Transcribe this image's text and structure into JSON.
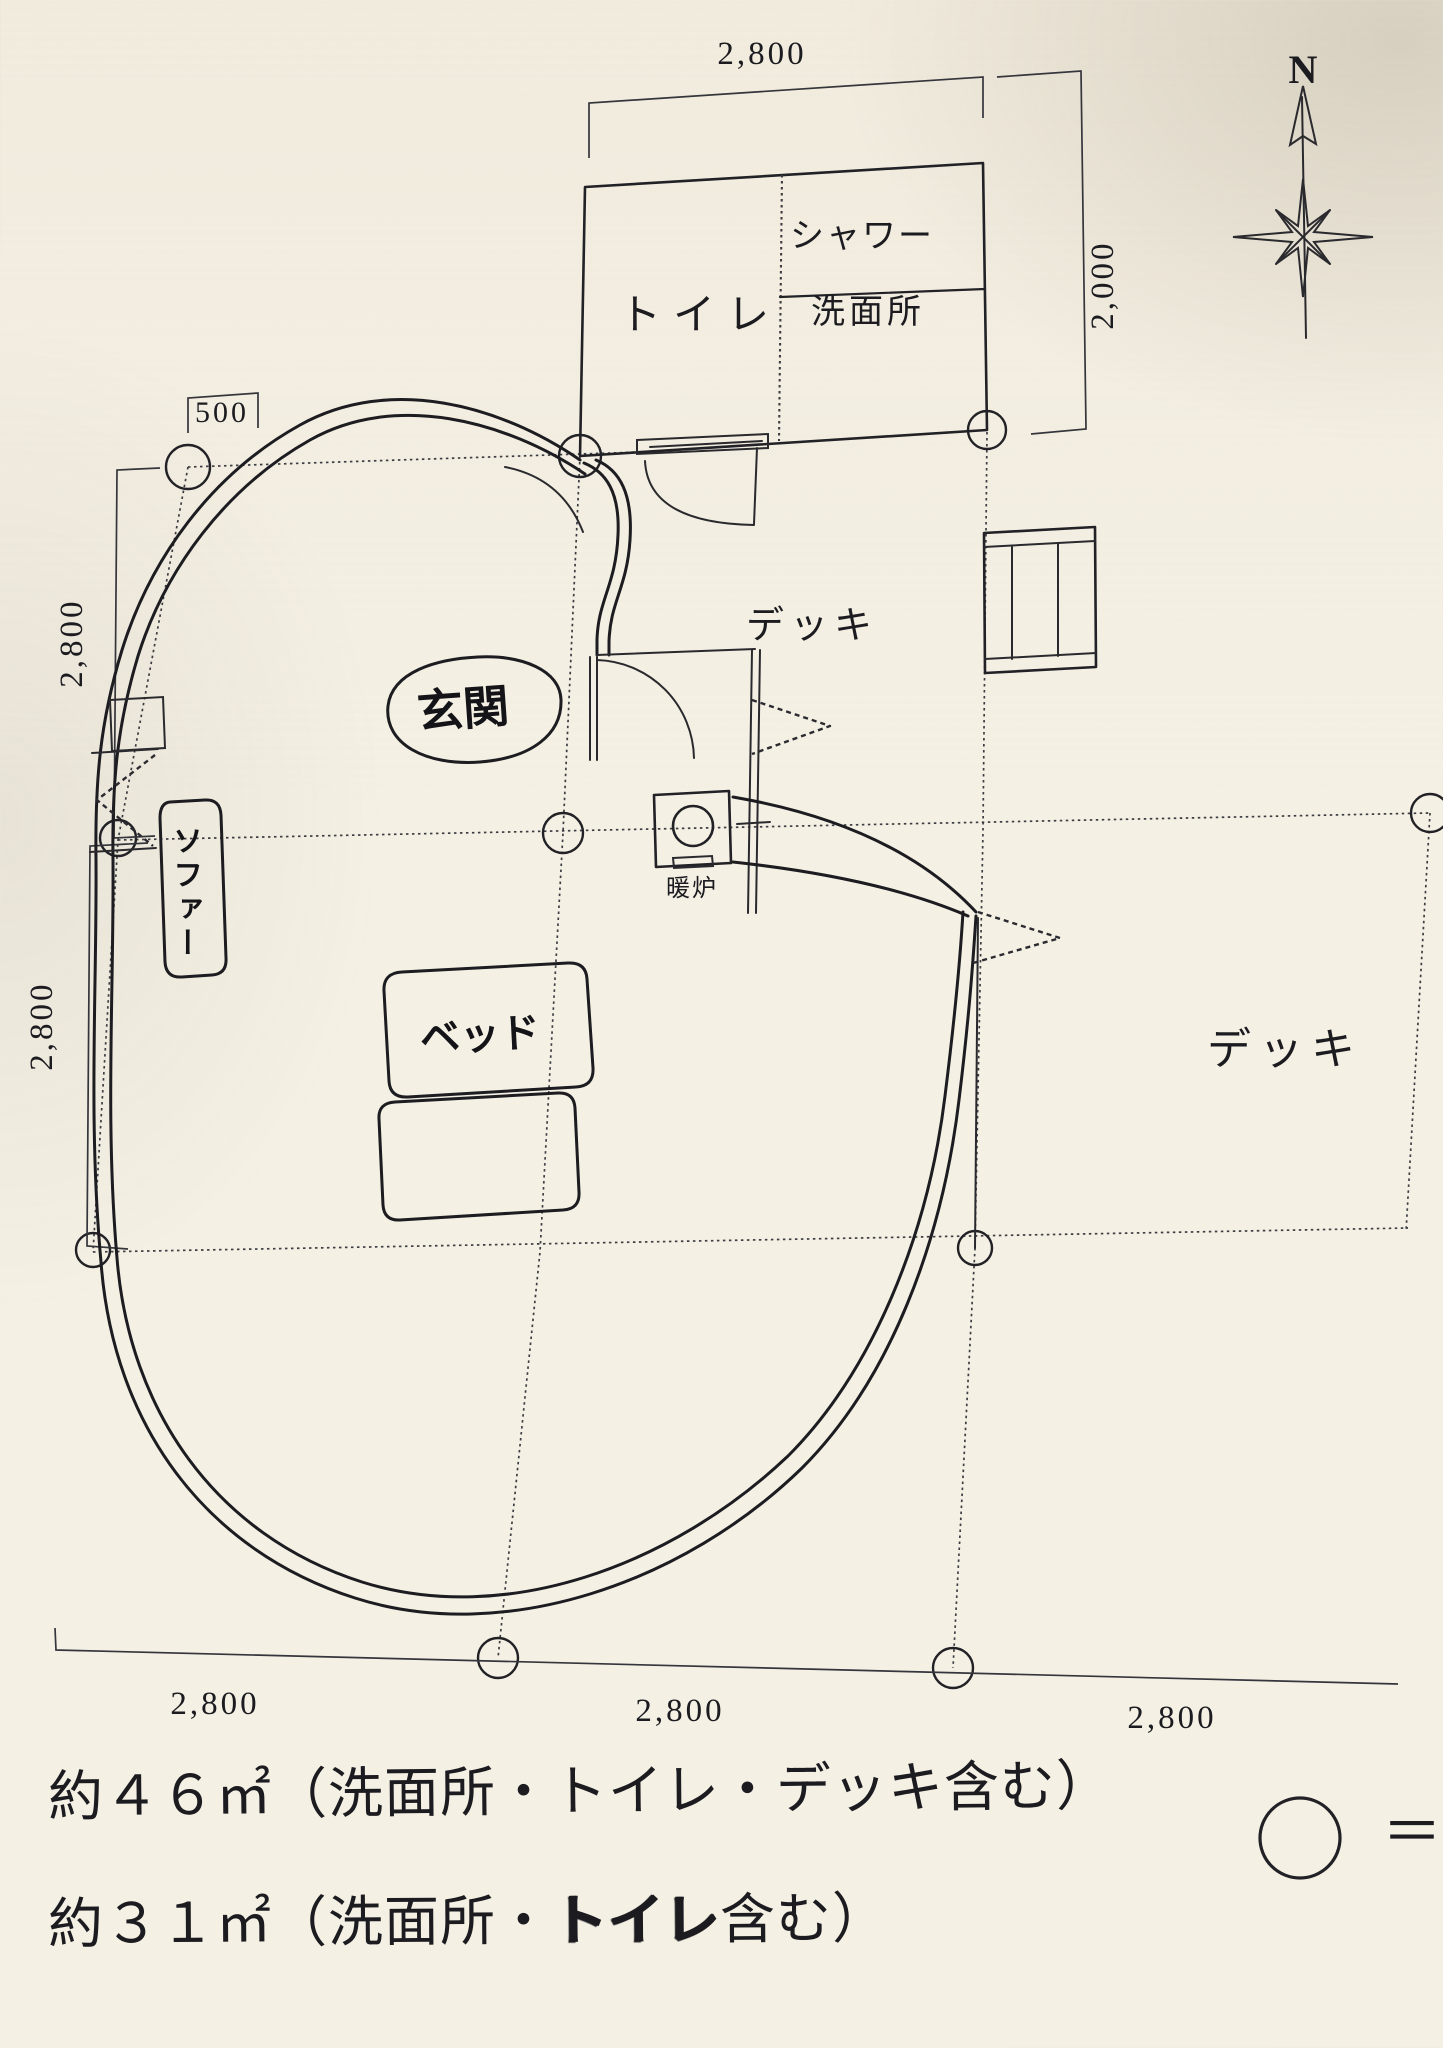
{
  "compass": {
    "north_label": "N"
  },
  "rooms": {
    "toilet": "トイレ",
    "shower": "シャワー",
    "washroom": "洗面所",
    "entrance": "玄関",
    "deck_upper": "デッキ",
    "deck_right": "デッキ",
    "fireplace": "暖炉",
    "sofa": "ソファー",
    "bed": "ベッド"
  },
  "dimensions": {
    "top_width": "2,800",
    "right_height": "2,000",
    "entry_offset": "500",
    "left_upper": "2,800",
    "left_lower": "2,800",
    "bottom_left": "2,800",
    "bottom_center": "2,800",
    "bottom_right": "2,800"
  },
  "notes": {
    "area_with_deck": "約４６㎡（洗面所・トイレ・デッキ含む）",
    "area_without_deck_prefix": "約３１㎡（洗面所・",
    "area_without_deck_stamp": "トイレ",
    "area_without_deck_suffix": "含む）",
    "legend_symbol": "＝"
  }
}
